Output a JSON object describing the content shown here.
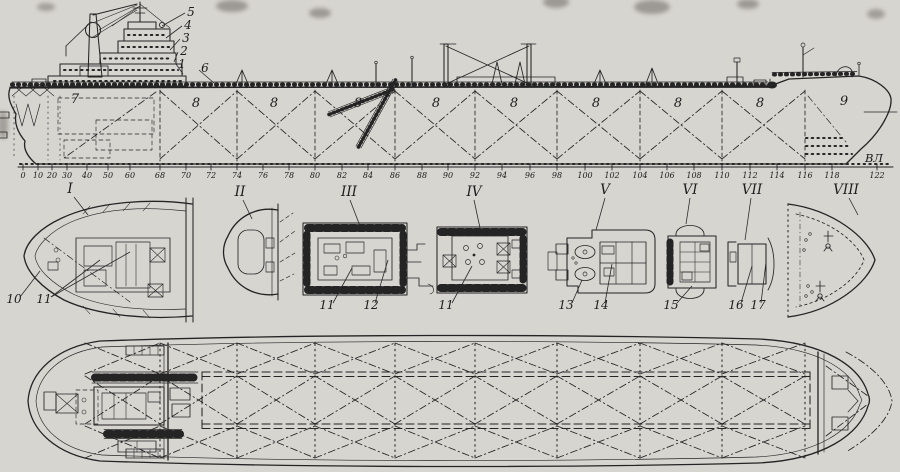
{
  "palette": {
    "background": "#d7d5d0",
    "ink": "#242424"
  },
  "profile": {
    "waterline_label": {
      "text": "ВЛ"
    },
    "hold_labels": [
      {
        "t": "7",
        "x": 75,
        "y": 103
      },
      {
        "t": "8",
        "x": 196,
        "y": 107
      },
      {
        "t": "8",
        "x": 274,
        "y": 107
      },
      {
        "t": "8",
        "x": 358,
        "y": 107
      },
      {
        "t": "8",
        "x": 436,
        "y": 107
      },
      {
        "t": "8",
        "x": 514,
        "y": 107
      },
      {
        "t": "8",
        "x": 596,
        "y": 107
      },
      {
        "t": "8",
        "x": 678,
        "y": 107
      },
      {
        "t": "8",
        "x": 760,
        "y": 107
      },
      {
        "t": "9",
        "x": 844,
        "y": 105
      }
    ],
    "callouts": [
      {
        "t": "5",
        "x": 191,
        "y": 16,
        "leader": [
          [
            185,
            13
          ],
          [
            162,
            26
          ]
        ]
      },
      {
        "t": "4",
        "x": 188,
        "y": 29,
        "leader": [
          [
            182,
            26
          ],
          [
            166,
            38
          ]
        ]
      },
      {
        "t": "3",
        "x": 186,
        "y": 42,
        "leader": [
          [
            180,
            39
          ],
          [
            170,
            50
          ]
        ]
      },
      {
        "t": "2",
        "x": 184,
        "y": 55,
        "leader": [
          [
            178,
            52
          ],
          [
            174,
            62
          ]
        ]
      },
      {
        "t": "1",
        "x": 182,
        "y": 68,
        "leader": [
          [
            176,
            64
          ],
          [
            183,
            74
          ]
        ]
      },
      {
        "t": "6",
        "x": 205,
        "y": 72,
        "leader": [
          [
            199,
            70
          ],
          [
            214,
            83
          ]
        ]
      }
    ],
    "bulkheads_x": [
      160,
      237,
      315,
      395,
      475,
      557,
      640,
      722,
      805
    ],
    "frame_scale": {
      "ticks": [
        {
          "t": "0",
          "x": 23
        },
        {
          "t": "10",
          "x": 38
        },
        {
          "t": "20",
          "x": 52
        },
        {
          "t": "30",
          "x": 67
        },
        {
          "t": "40",
          "x": 87
        },
        {
          "t": "50",
          "x": 108
        },
        {
          "t": "60",
          "x": 130
        },
        {
          "t": "68",
          "x": 160
        },
        {
          "t": "70",
          "x": 186
        },
        {
          "t": "72",
          "x": 211
        },
        {
          "t": "74",
          "x": 237
        },
        {
          "t": "76",
          "x": 263
        },
        {
          "t": "78",
          "x": 289
        },
        {
          "t": "80",
          "x": 315
        },
        {
          "t": "82",
          "x": 342
        },
        {
          "t": "84",
          "x": 368
        },
        {
          "t": "86",
          "x": 395
        },
        {
          "t": "88",
          "x": 422
        },
        {
          "t": "90",
          "x": 448
        },
        {
          "t": "92",
          "x": 475
        },
        {
          "t": "94",
          "x": 502
        },
        {
          "t": "96",
          "x": 530
        },
        {
          "t": "98",
          "x": 557
        },
        {
          "t": "100",
          "x": 585
        },
        {
          "t": "102",
          "x": 612
        },
        {
          "t": "104",
          "x": 640
        },
        {
          "t": "106",
          "x": 667
        },
        {
          "t": "108",
          "x": 694
        },
        {
          "t": "110",
          "x": 722
        },
        {
          "t": "112",
          "x": 750
        },
        {
          "t": "114",
          "x": 777
        },
        {
          "t": "116",
          "x": 805
        },
        {
          "t": "118",
          "x": 832
        },
        {
          "t": "122",
          "x": 877
        }
      ]
    }
  },
  "sections": [
    {
      "numeral": "I",
      "nx": 70,
      "ny": 193,
      "leader": [
        [
          74,
          197
        ],
        [
          88,
          215
        ]
      ],
      "callouts": [
        {
          "t": "10",
          "x": 14,
          "y": 303,
          "leaders": [
            [
              [
                20,
                297
              ],
              [
                40,
                271
              ]
            ]
          ]
        },
        {
          "t": "11",
          "x": 44,
          "y": 303,
          "leaders": [
            [
              [
                51,
                297
              ],
              [
                100,
                260
              ]
            ],
            [
              [
                51,
                297
              ],
              [
                130,
                252
              ]
            ]
          ]
        }
      ]
    },
    {
      "numeral": "II",
      "nx": 240,
      "ny": 196,
      "leader": [
        [
          243,
          200
        ],
        [
          252,
          219
        ]
      ],
      "callouts": []
    },
    {
      "numeral": "III",
      "nx": 349,
      "ny": 196,
      "leader": [
        [
          350,
          200
        ],
        [
          360,
          226
        ]
      ],
      "callouts": [
        {
          "t": "11",
          "x": 327,
          "y": 309,
          "leaders": [
            [
              [
                333,
                303
              ],
              [
                352,
                268
              ]
            ]
          ]
        },
        {
          "t": "12",
          "x": 371,
          "y": 309,
          "leaders": [
            [
              [
                375,
                303
              ],
              [
                388,
                260
              ]
            ]
          ]
        }
      ]
    },
    {
      "numeral": "IV",
      "nx": 474,
      "ny": 196,
      "leader": [
        [
          474,
          200
        ],
        [
          480,
          228
        ]
      ],
      "callouts": [
        {
          "t": "11",
          "x": 446,
          "y": 309,
          "leaders": [
            [
              [
                452,
                303
              ],
              [
                472,
                266
              ]
            ]
          ]
        }
      ]
    },
    {
      "numeral": "V",
      "nx": 605,
      "ny": 194,
      "leader": [
        [
          605,
          198
        ],
        [
          596,
          230
        ]
      ],
      "callouts": [
        {
          "t": "13",
          "x": 566,
          "y": 309,
          "leaders": [
            [
              [
                572,
                303
              ],
              [
                582,
                280
              ]
            ]
          ]
        },
        {
          "t": "14",
          "x": 601,
          "y": 309,
          "leaders": [
            [
              [
                605,
                303
              ],
              [
                612,
                264
              ]
            ]
          ]
        }
      ]
    },
    {
      "numeral": "VI",
      "nx": 690,
      "ny": 194,
      "leader": [
        [
          690,
          198
        ],
        [
          686,
          224
        ]
      ],
      "callouts": [
        {
          "t": "15",
          "x": 671,
          "y": 309,
          "leaders": [
            [
              [
                677,
                303
              ],
              [
                692,
                286
              ]
            ]
          ]
        }
      ]
    },
    {
      "numeral": "VII",
      "nx": 752,
      "ny": 194,
      "leader": [
        [
          751,
          198
        ],
        [
          745,
          240
        ]
      ],
      "callouts": [
        {
          "t": "16",
          "x": 736,
          "y": 309,
          "leaders": [
            [
              [
                741,
                303
              ],
              [
                752,
                266
              ]
            ]
          ]
        },
        {
          "t": "17",
          "x": 758,
          "y": 309,
          "leaders": [
            [
              [
                761,
                303
              ],
              [
                766,
                262
              ]
            ]
          ]
        }
      ]
    },
    {
      "numeral": "VIII",
      "nx": 846,
      "ny": 194,
      "leader": [
        [
          849,
          198
        ],
        [
          858,
          215
        ]
      ],
      "callouts": []
    }
  ],
  "plan": {
    "bulkheads_x": [
      85,
      160,
      237,
      315,
      395,
      475,
      557,
      640,
      722,
      805
    ]
  }
}
